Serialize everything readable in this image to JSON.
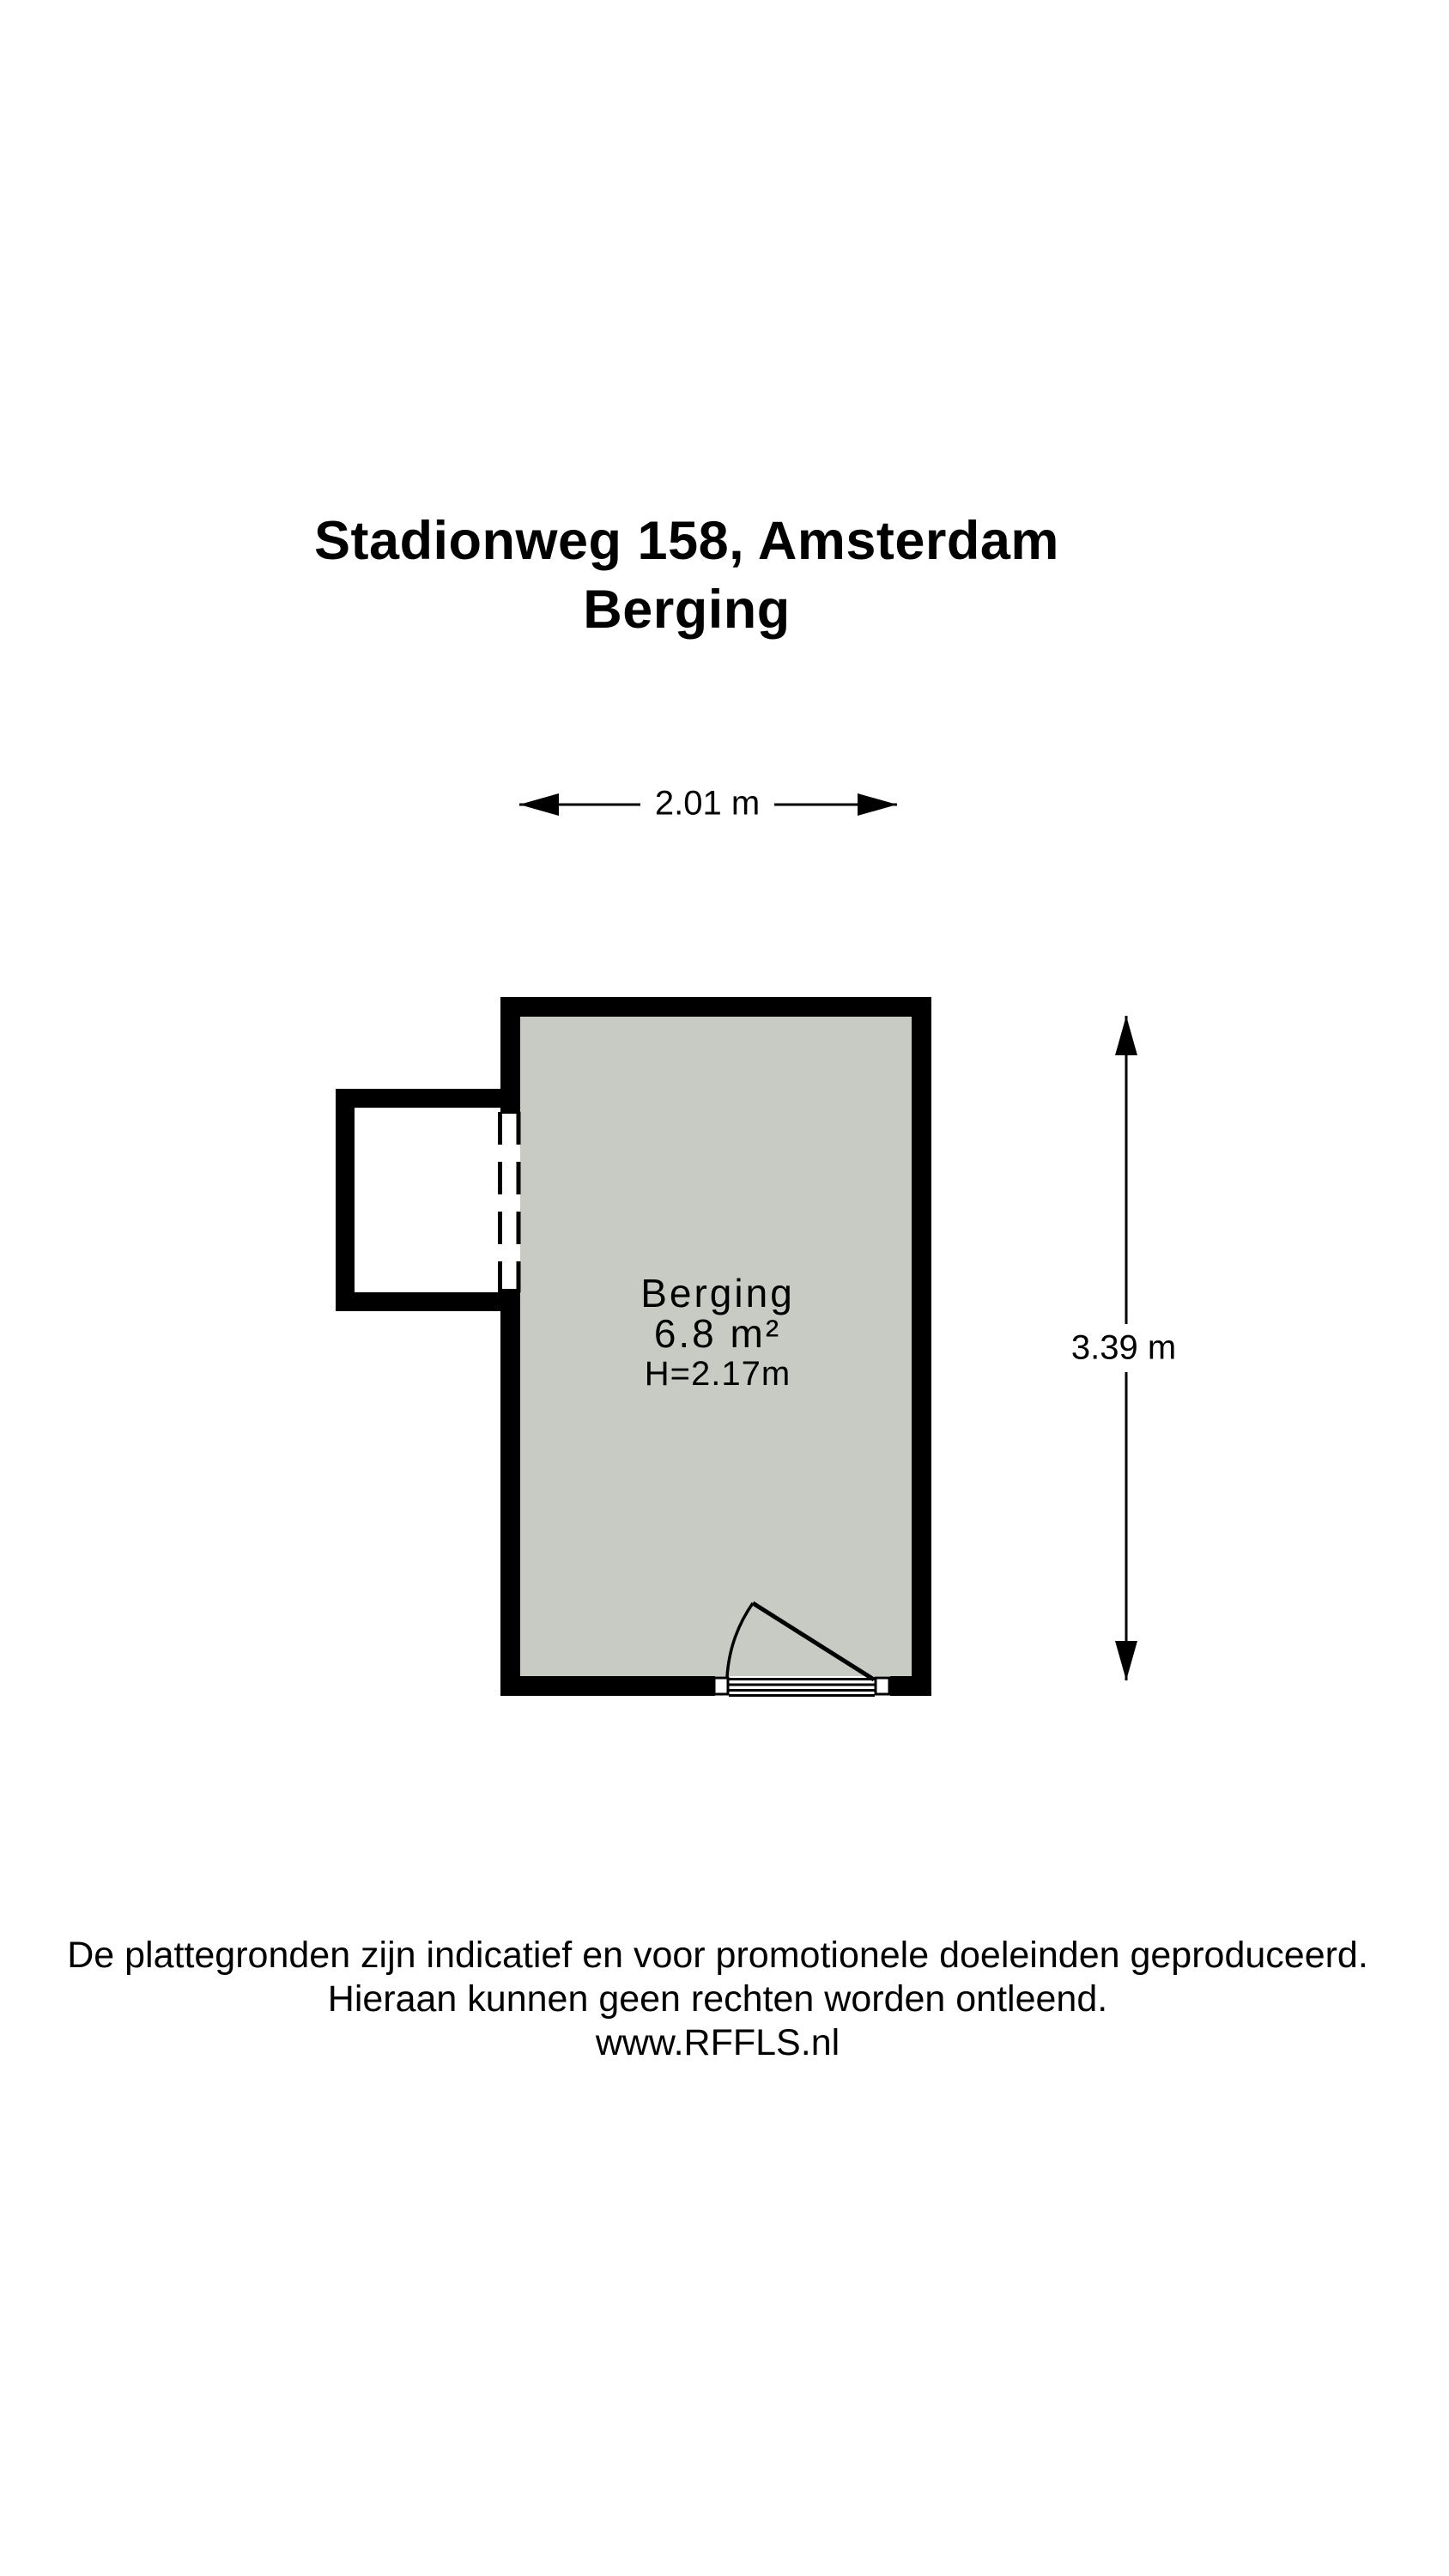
{
  "header": {
    "title_line1": "Stadionweg 158, Amsterdam",
    "title_line2": "Berging"
  },
  "floorplan": {
    "room_label": "Berging",
    "room_area": "6.8 m²",
    "ceiling_height": "H=2.17m",
    "dim_width": "2.01 m",
    "dim_height": "3.39 m",
    "colors": {
      "wall": "#000000",
      "floor": "#c8cbc4",
      "background": "#ffffff"
    }
  },
  "footer": {
    "disclaimer_line1": "De plattegronden zijn indicatief en voor promotionele doeleinden geproduceerd.",
    "disclaimer_line2": "Hieraan kunnen geen rechten worden ontleend.",
    "website": "www.RFFLS.nl"
  }
}
